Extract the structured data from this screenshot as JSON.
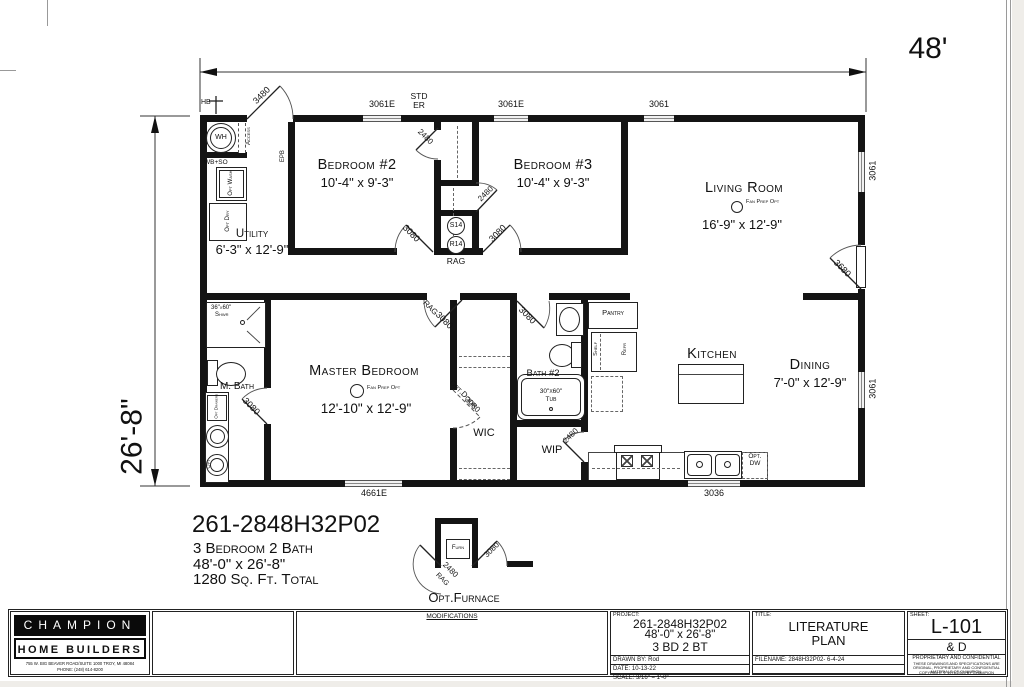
{
  "colors": {
    "ink": "#141414",
    "paper": "#ffffff",
    "page_bg": "#efede9"
  },
  "dimensions": {
    "overall_width": "48'",
    "overall_height": "26'-8\""
  },
  "rooms": {
    "bedroom2": {
      "name": "Bedroom #2",
      "size": "10'-4\" x 9'-3\""
    },
    "bedroom3": {
      "name": "Bedroom #3",
      "size": "10'-4\" x 9'-3\""
    },
    "living": {
      "name": "Living Room",
      "size": "16'-9\" x 12'-9\""
    },
    "utility": {
      "name": "Utility",
      "size": "6'-3\" x 12'-9\""
    },
    "master": {
      "name": "Master Bedroom",
      "size": "12'-10\" x 12'-9\""
    },
    "mbath": {
      "name": "M. Bath"
    },
    "bath2": {
      "name": "Bath #2"
    },
    "kitchen": {
      "name": "Kitchen"
    },
    "dining": {
      "name": "Dining",
      "size": "7'-0\" x 12'-9\""
    },
    "wic": {
      "name": "WIC"
    },
    "wip": {
      "name": "WIP"
    },
    "pantry": {
      "name": "Pantry"
    }
  },
  "labels": {
    "hb": "HB",
    "wh": "WH",
    "access": "Access",
    "wb_so": "WB+SO",
    "opt_wash": "Opt Wash",
    "opt_dry": "Opt Dry",
    "epb": "EPB",
    "std": "STD",
    "er": "ER",
    "s14": "S14",
    "r14": "R14",
    "rag": "RAG",
    "shower_size": "36\"x60\"",
    "shwr": "Shwr",
    "tub_size": "30\"x60\"",
    "tub": "Tub",
    "opt_drawers": "Opt Drawers",
    "opt": "Opt",
    "refr": "Refr",
    "shelf": "Shelf",
    "opt_dw_1": "Opt.",
    "opt_dw_2": "DW",
    "furn": "Furn",
    "opt_furnace": "Opt.Furnace",
    "opt_door": "Opt.Door",
    "fan_prep": "Fan Prep Opt"
  },
  "openings": {
    "door_3480": "3480",
    "door_2480": "2480",
    "door_3080": "3080",
    "door_3680": "3680",
    "win_3061e": "3061E",
    "win_3061": "3061",
    "win_4661e": "4661E",
    "win_3036": "3036"
  },
  "summary": {
    "model": "261-2848H32P02",
    "config": "3 Bedroom 2 Bath",
    "size": "48'-0\" x 26'-8\"",
    "area": "1280 Sq. Ft. Total"
  },
  "title_block": {
    "brand_line1": "CHAMPION",
    "brand_line2": "HOME BUILDERS",
    "address_line1": "755 W. BIG BEAVER ROAD/SUITE 1000 TROY, MI 48084",
    "address_line2": "PHONE: (248) 614-8200",
    "modifications": "MODIFICATIONS",
    "project_label": "PROJECT:",
    "project_model": "261-2848H32P02",
    "project_size": "48'-0\" x 26'-8\"",
    "project_config": "3 BD 2 BT",
    "drawn_by": "DRAWN BY: Rod",
    "date": "DATE: 10-13-22",
    "scale": "SCALE: 3/16\" = 1'-0\"",
    "title_label": "TITLE:",
    "title_line1": "LITERATURE",
    "title_line2": "PLAN",
    "filename": "FILENAME: 2848H32P02- 6-4-24",
    "sheet_label": "SHEET:",
    "sheet_number": "L-101",
    "sheet_suffix": "& D",
    "confidential_title": "PROPRIETARY AND CONFIDENTIAL",
    "confidential_body": "THESE DRAWINGS AND SPECIFICATIONS ARE ORIGINAL, PROPRIETARY AND CONFIDENTIAL MATERIALS OF CHAMPION.",
    "copyright": "COPYRIGHT © 1976-2024 BY CHAMPION"
  }
}
